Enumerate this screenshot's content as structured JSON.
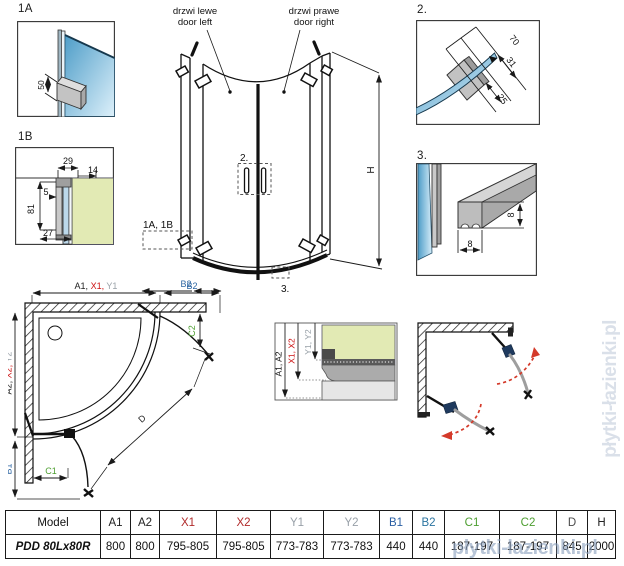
{
  "watermark": {
    "text": "płytki-łazienki.pl"
  },
  "colors": {
    "dim_red": "#cc1111",
    "dim_gray": "#99a1a8",
    "dim_blue": "#2d66a3",
    "dim_green": "#4d9e30",
    "swing_red": "#d43a2a",
    "hinge_navy": "#1f3a5e",
    "glass_blue": "#5fa8cf",
    "glass_green": "#e2eab4"
  },
  "details": {
    "d1a": {
      "label": "1A",
      "dim50": "50"
    },
    "d1b": {
      "label": "1B",
      "dim29": "29",
      "dim14": "14",
      "dim5": "5",
      "dim81": "81",
      "dim27": "27"
    },
    "d2": {
      "label": "2.",
      "dim70": "70",
      "dim31": "31",
      "dim25": "25"
    },
    "d3": {
      "label": "3.",
      "dim8v": "8",
      "dim8h": "8"
    }
  },
  "main": {
    "door_left_pl": "drzwi lewe",
    "door_left_en": "door left",
    "door_right_pl": "drzwi prawe",
    "door_right_en": "door right",
    "callout_handle": "2.",
    "callout_hinge": "1A, 1B",
    "callout_seal": "3.",
    "dim_h": "H",
    "dim_b2": "B2"
  },
  "plan": {
    "dim_a1": "A1, ",
    "dim_x1": "X1, ",
    "dim_y1": "Y1",
    "dim_b2": "B2",
    "dim_a2": "A2, ",
    "dim_x2": "X2, ",
    "dim_y2": "Y2",
    "dim_b1": "B1",
    "dim_c1": "C1",
    "dim_c2": "C2",
    "dim_d": "D"
  },
  "section": {
    "dim_a": "A1, A2",
    "dim_x": "X1, X2",
    "dim_y": "Y1, Y2"
  },
  "table": {
    "headers": [
      "Model",
      "A1",
      "A2",
      "X1",
      "X2",
      "Y1",
      "Y2",
      "B1",
      "B2",
      "C1",
      "C2",
      "D",
      "H"
    ],
    "header_colors": [
      "#111111",
      "#222222",
      "#222222",
      "#b02a2a",
      "#b02a2a",
      "#98a0a8",
      "#98a0a8",
      "#2b5fa3",
      "#2b74a0",
      "#4d9e30",
      "#4d9e30",
      "#4a4a4a",
      "#222222"
    ],
    "rows": [
      [
        "PDD 80Lx80R",
        "800",
        "800",
        "795-805",
        "795-805",
        "773-783",
        "773-783",
        "440",
        "440",
        "187-197",
        "187-197",
        "845",
        "2000"
      ]
    ]
  }
}
